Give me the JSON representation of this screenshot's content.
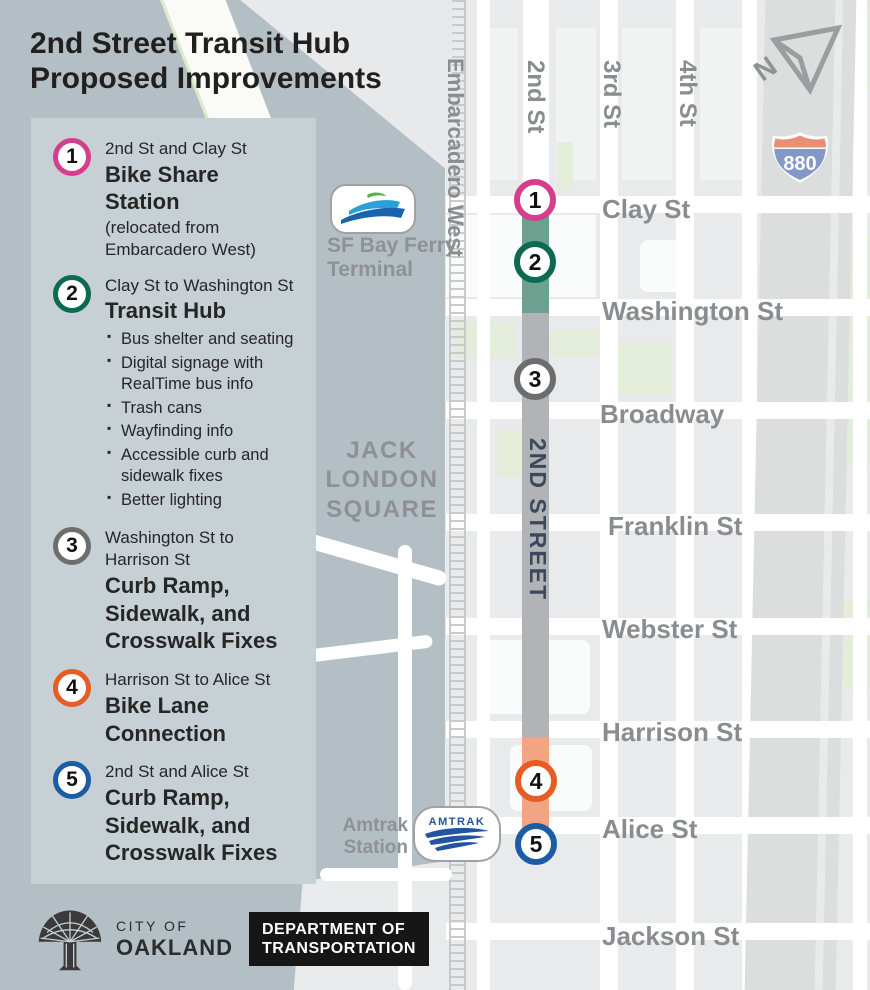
{
  "title": {
    "line1": "2nd Street Transit Hub",
    "line2": "Proposed Improvements"
  },
  "legend": {
    "items": [
      {
        "number": "1",
        "ring_color": "#d33f8d",
        "location": "2nd St and Clay St",
        "title": "Bike Share Station",
        "note": "(relocated from Embarcadero West)"
      },
      {
        "number": "2",
        "ring_color": "#0c6a51",
        "location": "Clay St to Washington St",
        "title": "Transit Hub",
        "bullets": [
          "Bus shelter and seating",
          "Digital signage with RealTime bus info",
          "Trash cans",
          "Wayfinding info",
          "Accessible curb and sidewalk fixes",
          "Better lighting"
        ]
      },
      {
        "number": "3",
        "ring_color": "#6c6d6f",
        "location": "Washington St to Harrison St",
        "title": "Curb Ramp, Sidewalk, and Crosswalk Fixes"
      },
      {
        "number": "4",
        "ring_color": "#e55c24",
        "location": "Harrison St to Alice St",
        "title": "Bike Lane Connection"
      },
      {
        "number": "5",
        "ring_color": "#1b5ca5",
        "location": "2nd St and Alice St",
        "title": "Curb Ramp, Sidewalk, and Crosswalk Fixes"
      }
    ]
  },
  "map": {
    "corridor_label": "2ND STREET",
    "vertical_streets": [
      "Embarcadero West",
      "2nd St",
      "3rd St",
      "4th St"
    ],
    "cross_streets": [
      "Clay St",
      "Washington St",
      "Broadway",
      "Franklin St",
      "Webster St",
      "Harrison St",
      "Alice St",
      "Jackson St"
    ],
    "area_label_lines": [
      "JACK",
      "LONDON",
      "SQUARE"
    ],
    "ferry_label_line1": "SF Bay Ferry",
    "ferry_label_line2": "Terminal",
    "amtrak_label_line1": "Amtrak",
    "amtrak_label_line2": "Station",
    "amtrak_logo_text": "AMTRAK",
    "highway_shield": "880",
    "north_label": "N",
    "segment_colors": {
      "transit_hub_green": "#6ba18e",
      "fixes_gray": "#b1b3b6",
      "bike_lane_orange": "#f3a583"
    }
  },
  "footer": {
    "city_label_line1": "CITY OF",
    "city_label_line2": "OAKLAND",
    "dept_line1": "DEPARTMENT OF",
    "dept_line2": "TRANSPORTATION"
  },
  "colors": {
    "backdrop": "#b4bfc5",
    "panel": "#c7d0d4",
    "map_bg": "#e9eaeb",
    "park": "#e4edd9",
    "freeway": "#dcdddd",
    "street_label": "#8a8c8f",
    "corridor_text": "#3a495d",
    "amtrak_blue": "#24549e",
    "shield_red": "#e9886c",
    "shield_blue": "#7c92c8"
  }
}
